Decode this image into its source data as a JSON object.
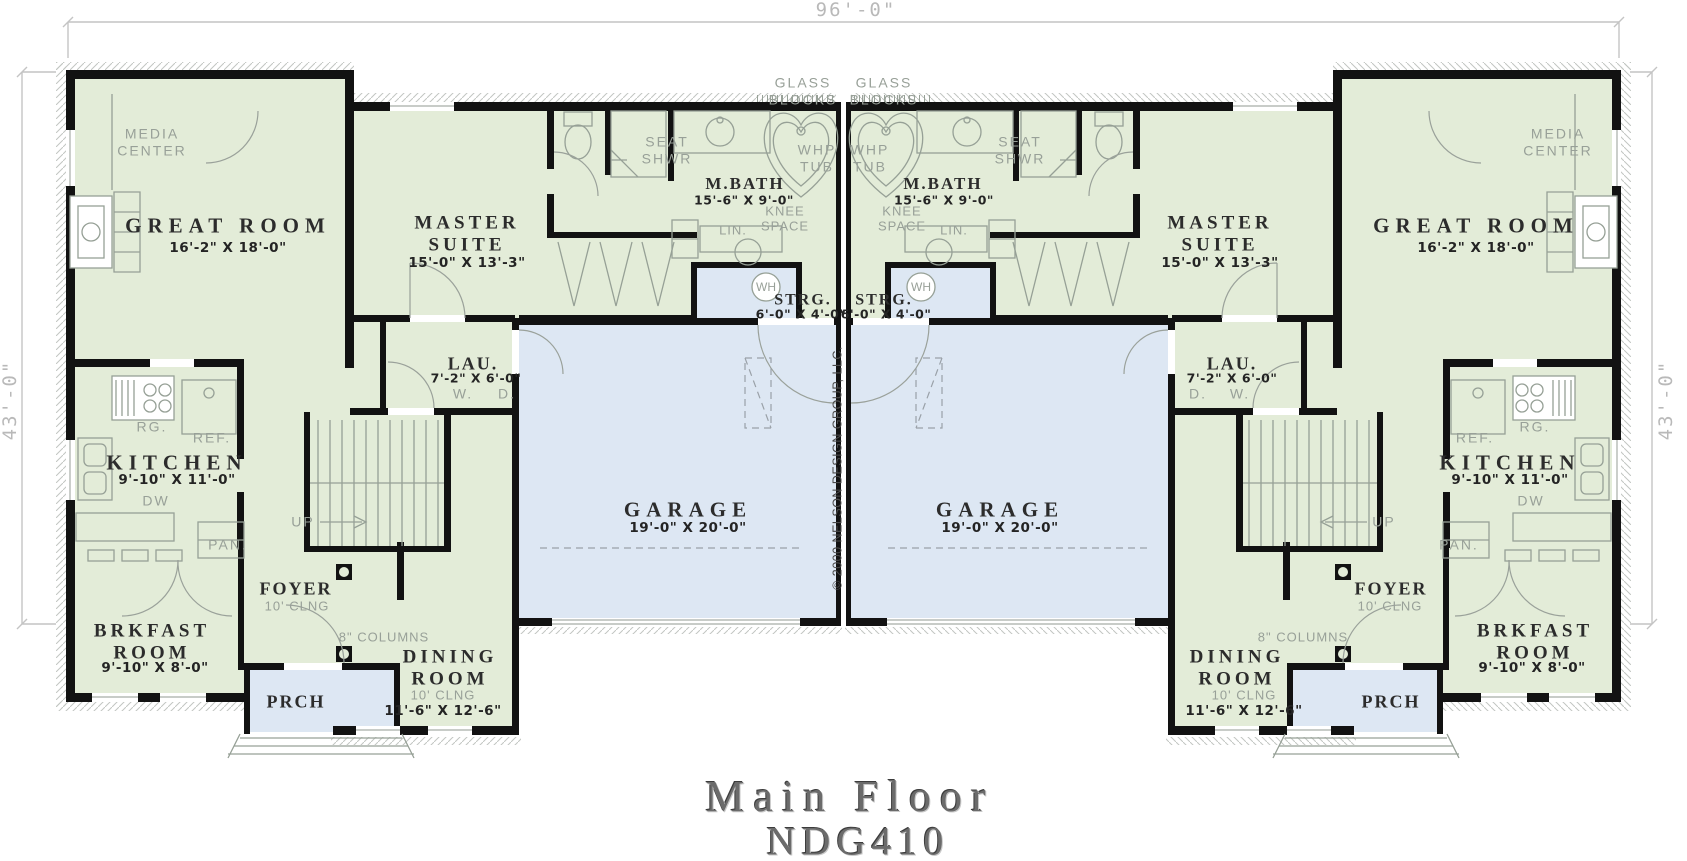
{
  "title": {
    "name": "Main Floor",
    "plan_number": "NDG410"
  },
  "copyright": "© 2000 NELSON DESIGN GROUP, LLC.",
  "dimensions": {
    "overall_width": "96'-0\"",
    "overall_depth_left": "43'-0\"",
    "overall_depth_right": "43'-0\""
  },
  "rooms": {
    "great_room": {
      "name": "GREAT ROOM",
      "dims": "16'-2\" X 18'-0\""
    },
    "master_suite": {
      "name": "MASTER\nSUITE",
      "dims": "15'-0\" X 13'-3\""
    },
    "m_bath": {
      "name": "M.BATH",
      "dims": "15'-6\" X 9'-0\""
    },
    "strg": {
      "name": "STRG.",
      "dims": "6'-0\" X 4'-0\""
    },
    "lau": {
      "name": "LAU.",
      "dims": "7'-2\" X 6'-0\""
    },
    "kitchen": {
      "name": "KITCHEN",
      "dims": "9'-10\" X 11'-0\""
    },
    "brkfast": {
      "name": "BRKFAST\nROOM",
      "dims": "9'-10\" X 8'-0\""
    },
    "foyer": {
      "name": "FOYER",
      "ceiling": "10' CLNG"
    },
    "dining": {
      "name": "DINING\nROOM",
      "ceiling": "10' CLNG",
      "dims": "11'-6\" X 12'-6\""
    },
    "garage": {
      "name": "GARAGE",
      "dims": "19'-0\" X 20'-0\""
    },
    "prch": {
      "name": "PRCH"
    }
  },
  "annotations": {
    "media_center": "MEDIA\nCENTER",
    "glass_blocks": "GLASS\nBLOCKS",
    "seat_shwr": "SEAT\nSHWR",
    "whp_tub": "WHP\nTUB",
    "knee_space": "KNEE\nSPACE",
    "lin": "LIN.",
    "wh": "WH",
    "w": "W.",
    "d": "D.",
    "rg": "RG.",
    "ref": "REF.",
    "dw": "DW",
    "pan": "PAN.",
    "up": "UP",
    "columns": "8\" COLUMNS",
    "clng_10": "10' CLNG"
  },
  "colors": {
    "room_fill": "#e3ecd8",
    "garage_fill": "#dde7f3",
    "wall": "#121212",
    "fixture_line": "#96a096",
    "annotation_text": "#98a098",
    "measure_text": "#b9b9b9",
    "room_text": "#2c2c2c",
    "title_text": "#6b6b6b"
  }
}
